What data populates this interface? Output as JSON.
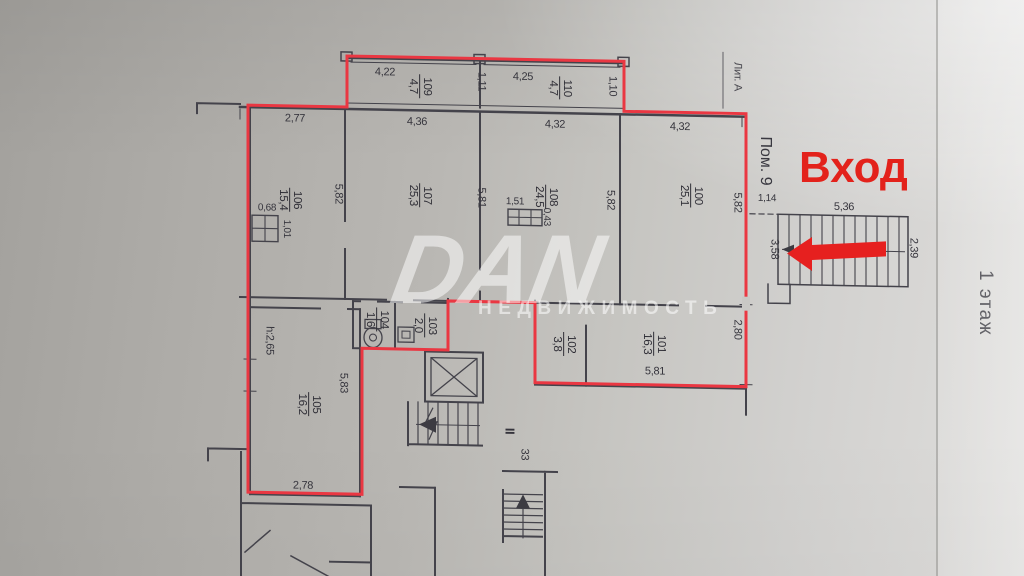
{
  "labels": {
    "entrance": "Вход",
    "premise": "Пом. 9",
    "liter": "Лит. А",
    "floor": "1 этаж",
    "section": "II",
    "apartment_number": "33"
  },
  "watermark": {
    "name": "DAN",
    "tagline": "НЕДВИЖИМОСТЬ"
  },
  "colors": {
    "outline": "#ea3742",
    "annotation": "#e6201f",
    "ink": "#44434b"
  },
  "rooms": {
    "r100": {
      "number": "100",
      "area": "25,1"
    },
    "r101": {
      "number": "101",
      "area": "16,3"
    },
    "r102": {
      "number": "102",
      "area": "3,8"
    },
    "r103": {
      "number": "103",
      "area": "2,0"
    },
    "r104": {
      "number": "104",
      "area": "1,6"
    },
    "r105": {
      "number": "105",
      "area": "16,2"
    },
    "r106": {
      "number": "106",
      "area": "15,4"
    },
    "r107": {
      "number": "107",
      "area": "25,3"
    },
    "r108": {
      "number": "108",
      "area": "24,5"
    },
    "r109": {
      "number": "109",
      "area": "4,7"
    },
    "r110": {
      "number": "110",
      "area": "4,7"
    }
  },
  "dims": {
    "d422": "4,22",
    "d111": "1,11",
    "d425": "4,25",
    "d110": "1,10",
    "d277": "2,77",
    "d436": "4,36",
    "d432a": "4,32",
    "d432b": "4,32",
    "d582a": "5,82",
    "d581a": "5,81",
    "d582b": "5,82",
    "d582c": "5,82",
    "d068": "0,68",
    "d101": "1,01",
    "d151": "1,51",
    "d043": "0,43",
    "d114": "1,14",
    "d536": "5,36",
    "d239": "2,39",
    "d358": "3,58",
    "d280": "2,80",
    "d581b": "5,81",
    "dh265": "h:2,65",
    "d583": "5,83",
    "d278": "2,78"
  }
}
